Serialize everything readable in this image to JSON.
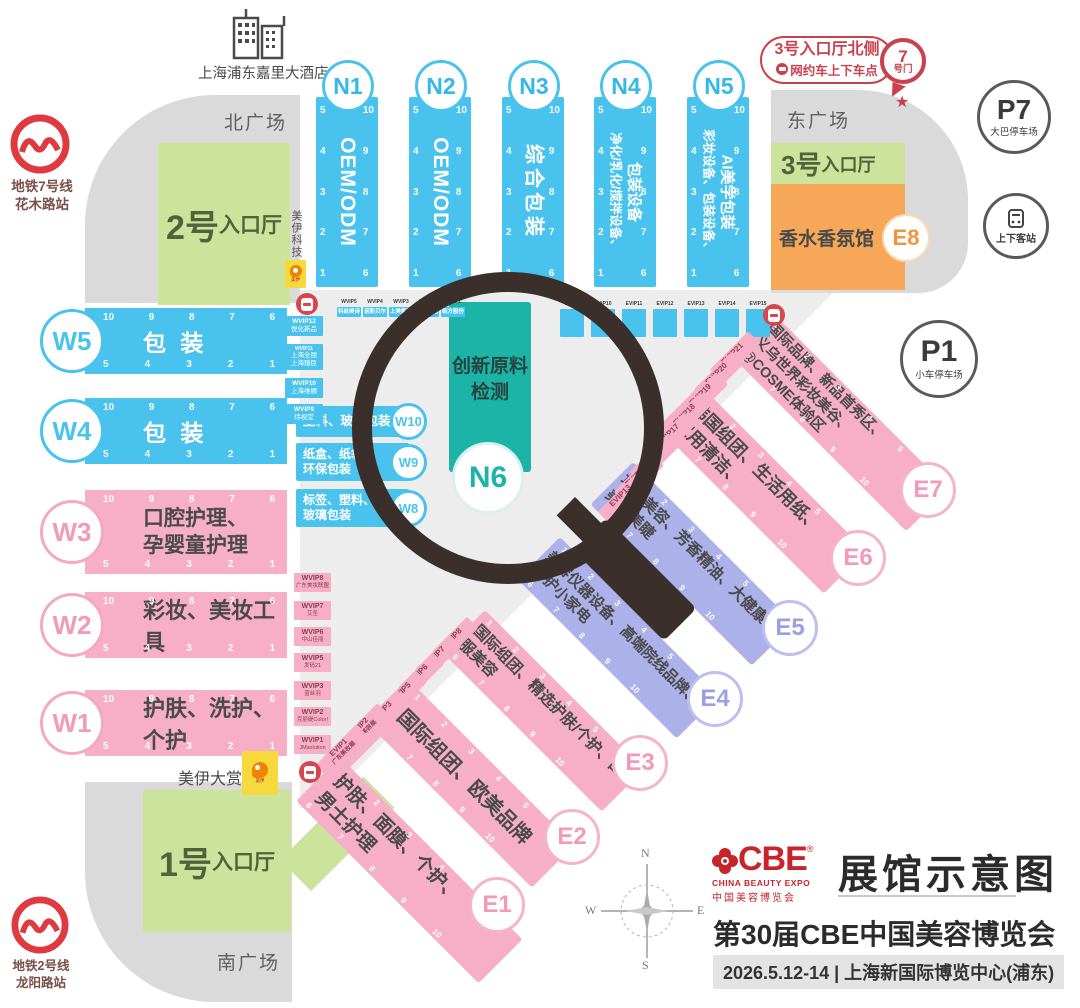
{
  "colors": {
    "blue": "#49c3ee",
    "pink": "#f7afc7",
    "purple": "#acb1ea",
    "teal": "#1db4a8",
    "green": "#cbe39a",
    "orange": "#f6a757",
    "plaza_gray": "#dadada",
    "floor_gray": "#ededed",
    "accent_red": "#cf4350",
    "logo_red": "#c8242c"
  },
  "plazas": {
    "north": "北广场",
    "east": "东广场",
    "south": "南广场"
  },
  "hotel": "上海浦东嘉里大酒店",
  "metro7": {
    "l1": "地铁7号线",
    "l2": "花木路站"
  },
  "metro2": {
    "l1": "地铁2号线",
    "l2": "龙阳路站"
  },
  "parking": {
    "p7": "P7",
    "p7_label": "大巴停车场",
    "p1": "P1",
    "p1_label": "小车停车场",
    "bus": "上下客站"
  },
  "gate7": {
    "num": "7",
    "label": "号门"
  },
  "ride": {
    "l1": "3号入口厅北侧",
    "l2": "网约车上下车点"
  },
  "star": "★",
  "entrances": {
    "hall1_big": "1号",
    "hall2_big": "2号",
    "hall3_big": "3号",
    "suffix": "入口厅"
  },
  "e8": {
    "id": "E8",
    "name": "香水香氛馆"
  },
  "n6": {
    "id": "N6",
    "l1": "创新原料",
    "l2": "检测"
  },
  "n_halls": [
    {
      "id": "N1",
      "l1": "OEM/ODM",
      "l2": ""
    },
    {
      "id": "N2",
      "l1": "OEM/ODM",
      "l2": ""
    },
    {
      "id": "N3",
      "l1": "综合包装",
      "l2": ""
    },
    {
      "id": "N4",
      "l1": "包装设备",
      "l2": "净化/乳化/搅拌设备、"
    },
    {
      "id": "N5",
      "l1": "AI美学包装",
      "l2": "彩妆设备、包装设备、"
    }
  ],
  "w_halls": [
    {
      "id": "W5",
      "l1": "包 装",
      "l2": ""
    },
    {
      "id": "W4",
      "l1": "包 装",
      "l2": ""
    },
    {
      "id": "W3",
      "l1": "口腔护理、",
      "l2": "孕婴童护理"
    },
    {
      "id": "W2",
      "l1": "彩妆、美妆工具",
      "l2": ""
    },
    {
      "id": "W1",
      "l1": "护肤、洗护、个护",
      "l2": ""
    }
  ],
  "w_sub": [
    {
      "id": "W10",
      "l1": "塑料、玻璃包装",
      "l2": ""
    },
    {
      "id": "W9",
      "l1": "纸盒、纸袋、",
      "l2": "环保包装"
    },
    {
      "id": "W8",
      "l1": "标签、塑料、",
      "l2": "玻璃包装"
    }
  ],
  "e_halls": [
    {
      "id": "E1",
      "name": "护肤、面膜、个护、男士护理"
    },
    {
      "id": "E2",
      "name": "国际组团、欧美品牌"
    },
    {
      "id": "E3",
      "name": "国际组团、精选护肤/个护、口服美容"
    },
    {
      "id": "E4",
      "name": "美容仪器设备、高端院线品牌、个护小家电"
    },
    {
      "id": "E5",
      "name": "功效美容、芳香精油、大健康、美甲美睫"
    },
    {
      "id": "E6",
      "name": "韩国组团、生活用纸、家用清洁、"
    },
    {
      "id": "E7",
      "name": "国际品牌、新品首秀区、义乌世界彩妆美谷、@COSME体验区"
    }
  ],
  "nums": {
    "n_left": [
      "5",
      "4",
      "3",
      "2",
      "1"
    ],
    "n_right": [
      "10",
      "9",
      "8",
      "7",
      "6"
    ],
    "w_top": [
      "10",
      "9",
      "8",
      "7",
      "6"
    ],
    "w_bot": [
      "5",
      "4",
      "3",
      "2",
      "1"
    ],
    "e_top": [
      "1",
      "2",
      "3",
      "4",
      "5"
    ],
    "e_bot": [
      "6",
      "7",
      "8",
      "9",
      "10"
    ]
  },
  "wvip_top": [
    {
      "id": "WVIP5",
      "name": "科丝美诗"
    },
    {
      "id": "WVIP4",
      "name": "诺斯贝尔"
    },
    {
      "id": "WVIP3",
      "name": "上美集团"
    },
    {
      "id": "WVIP2",
      "name": "环亚集团"
    },
    {
      "id": "WVIP1",
      "name": "临方股份"
    }
  ],
  "wvip_left": [
    {
      "id": "WVIP12",
      "name": "悦化新品",
      "name2": ""
    },
    {
      "id": "WVIP11",
      "name": "上海全丽",
      "name2": "上海臻臣"
    },
    {
      "id": "WVIP10",
      "name": "上海维娜",
      "name2": ""
    },
    {
      "id": "WVIP9",
      "name": "炜视堂",
      "name2": ""
    }
  ],
  "wvip_pink": [
    {
      "id": "WVIP8",
      "name": "广东美妆联盟"
    },
    {
      "id": "WVIP7",
      "name": "艾圣"
    },
    {
      "id": "WVIP6",
      "name": "中山佳丽"
    },
    {
      "id": "WVIP5",
      "name": "发码21"
    },
    {
      "id": "WVIP3",
      "name": "蓝丝羽"
    },
    {
      "id": "WVIP2",
      "name": "克丽缇Color!"
    },
    {
      "id": "WVIP1",
      "name": "JMsolution"
    }
  ],
  "evip_row": [
    "EVIP9",
    "EVIP10",
    "EVIP11",
    "EVIP12",
    "EVIP13",
    "EVIP14",
    "EVIP15"
  ],
  "evip_upper": [
    "EVIP21",
    "EVIP20",
    "EVIP19",
    "EVIP18",
    "EVIP17",
    "EVIP16",
    "EVIP15",
    "EVIP13"
  ],
  "evip_lower": [
    {
      "id": "EVIP8",
      "name": ""
    },
    {
      "id": "EVIP7",
      "name": ""
    },
    {
      "id": "EVIP6",
      "name": ""
    },
    {
      "id": "EVIP5",
      "name": ""
    },
    {
      "id": "EVIP3",
      "name": ""
    },
    {
      "id": "EVIP2",
      "name": "美妆美容展"
    },
    {
      "id": "EVIP1",
      "name": "广东美妆展"
    }
  ],
  "meiyi": {
    "tech": "美伊科技",
    "award": "美伊大赏"
  },
  "footer": {
    "cbe": "CBE",
    "reg": "®",
    "en": "CHINA BEAUTY EXPO",
    "cn": "中国美容博览会",
    "map_title": "展馆示意图",
    "expo_title": "第30届CBE中国美容博览会",
    "date_venue": "2026.5.12-14 | 上海新国际博览中心(浦东)"
  },
  "compass": {
    "n": "N",
    "e": "E",
    "s": "S",
    "w": "W"
  }
}
